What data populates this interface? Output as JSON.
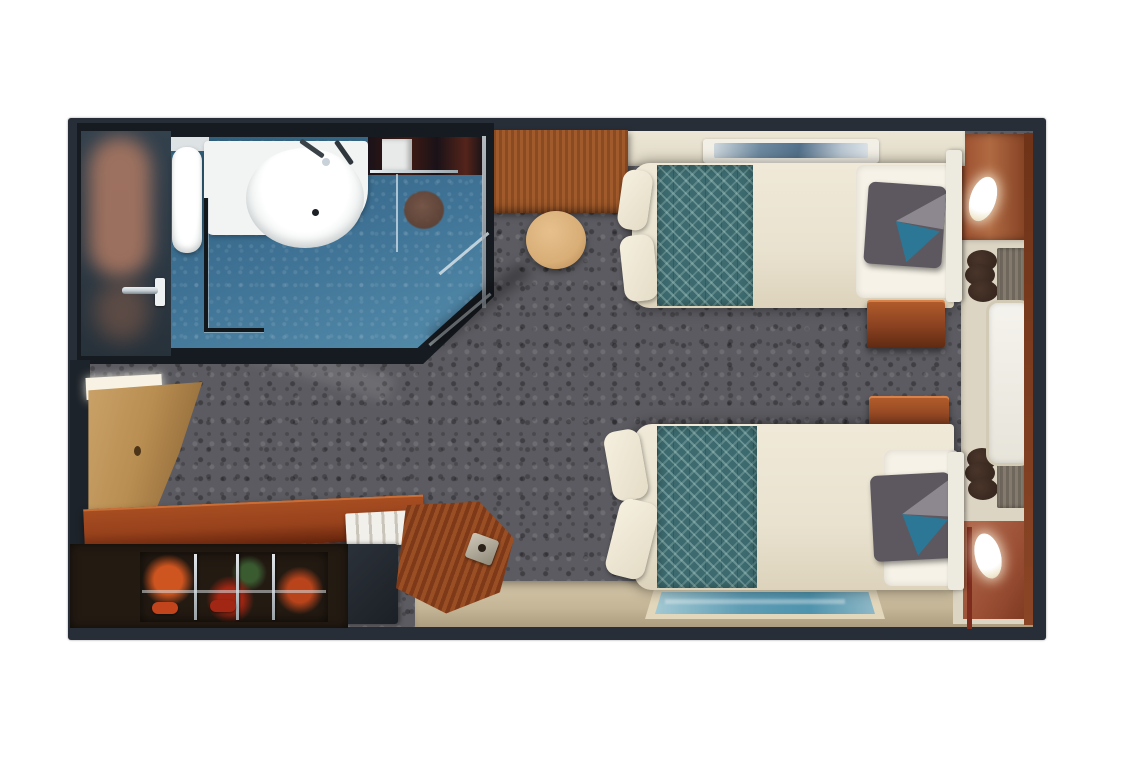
{
  "page": {
    "background": "#ffffff",
    "kind": "stateroom-floor-plan"
  },
  "colors": {
    "pageBg": "#ffffff",
    "frame": "#272e37",
    "carpet": "#5b5b61",
    "bathWall": "#161b21",
    "bathFloor": "#3d7093",
    "bathFloorLight": "#548cab",
    "vestibule": "#2c3944",
    "blurBlob": "#b07a63",
    "chrome": "#c9d2d8",
    "stool": "#d9ae77",
    "deskRed": "#98421c",
    "wallCream": "#ece6d6",
    "artBlue": "#6d89a0",
    "duvet": "#f0e9d8",
    "duvetShade": "#ddd3bc",
    "runner": "#3c6a6e",
    "sheet": "#f6f2e7",
    "pillow": "#5d5860",
    "pillowLight": "#8d8890",
    "pillowTeal": "#2c7795",
    "nightstandTop": "#b35d2c",
    "tanFloor": "#d3c5a7",
    "rugTeal": "#4f93ad",
    "rugLight": "#a3c9d3",
    "rugBorder": "#e2d6bb",
    "terracotta": "#b06a42",
    "alcove": "#ddd5c4",
    "windowWhite": "#f5f3ed",
    "chairDark": "#38281f",
    "chairGray": "#847b6e",
    "closetDark": "#231a12",
    "closetRed": "#8a2f16",
    "closetOrange": "#cf5520",
    "doorTan": "#b98e52",
    "glowWhite": "#f7f2e4"
  },
  "floorplan": {
    "items": {
      "plan": {
        "label": "Stateroom floor plan"
      },
      "bathroom": {
        "label": "Bathroom with blue tile floor"
      },
      "toilet": {
        "label": "Toilet"
      },
      "sink": {
        "label": "Washbasin with faucets"
      },
      "shower": {
        "label": "Shower with drain"
      },
      "bathroomDoor": {
        "label": "Bathroom door with handle"
      },
      "desk": {
        "label": "Wooden desk"
      },
      "stool": {
        "label": "Round stool"
      },
      "artwork": {
        "label": "Framed artwork above bed"
      },
      "bedTop": {
        "label": "Twin bed with teal runner"
      },
      "pillowTop": {
        "label": "Accent pillow"
      },
      "nightstandUpper": {
        "label": "Wooden nightstand"
      },
      "nightstandLower": {
        "label": "Wooden nightstand"
      },
      "bedBottom": {
        "label": "Twin bed with teal runner"
      },
      "pillowBottom": {
        "label": "Accent pillow"
      },
      "window": {
        "label": "Picture window"
      },
      "sconceUpper": {
        "label": "Wall sconce light"
      },
      "sconceLower": {
        "label": "Wall sconce light"
      },
      "entranceDoor": {
        "label": "Cabin entrance door (open)"
      },
      "vanity": {
        "label": "Vanity counter"
      },
      "deskChair": {
        "label": "Wooden desk chair"
      },
      "closet": {
        "label": "Open closet with clothes"
      },
      "rug": {
        "label": "Teal bedside rug"
      },
      "carpet": {
        "label": "Gray cabin carpet"
      }
    }
  }
}
